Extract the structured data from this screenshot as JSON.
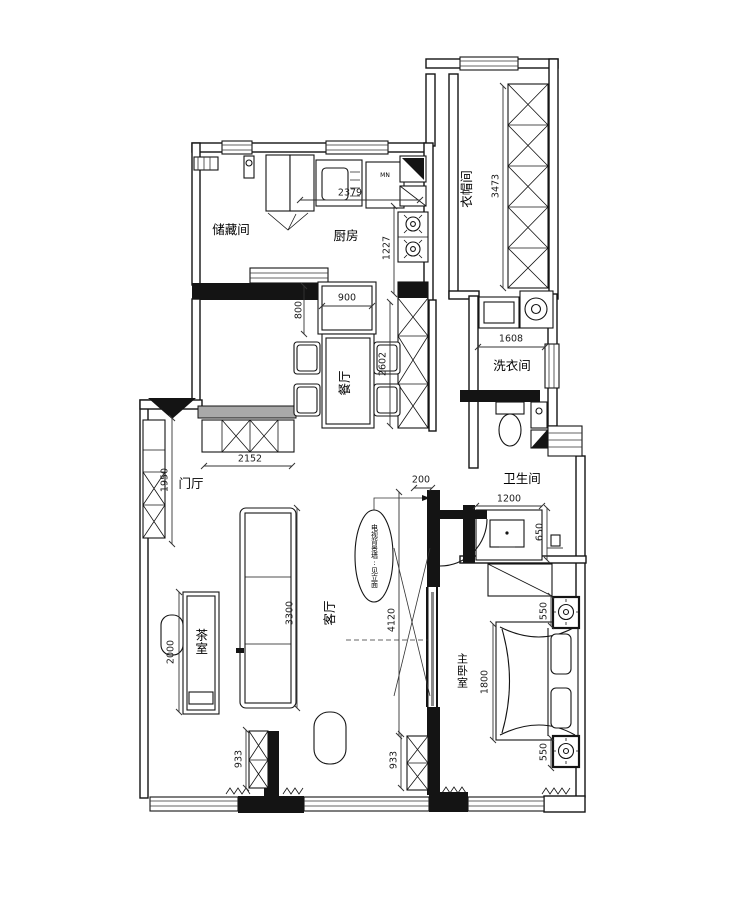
{
  "rooms": {
    "storage": "储藏间",
    "kitchen": "厨房",
    "cloakroom": "衣帽间",
    "laundry": "洗衣间",
    "dining": "餐厅",
    "bathroom": "卫生间",
    "hall": "门厅",
    "living": "客厅",
    "tea": "茶室",
    "master": "主卧室"
  },
  "dims": {
    "kitchen_width": "2379",
    "kitchen_depth": "1227",
    "cabinet_900": "900",
    "cabinet_800": "800",
    "tall_cabinet": "2602",
    "cloak_depth": "3473",
    "laundry_width": "1608",
    "hall_cabinet": "2152",
    "hall_depth": "1950",
    "wall_200": "200",
    "living_depth": "4120",
    "sofa_length": "3300",
    "tea_table": "2000",
    "cabinet_left": "933",
    "cabinet_right": "933",
    "vanity_width": "1200",
    "vanity_depth": "650",
    "bed_width": "1800",
    "nightstand_top": "550",
    "nightstand_bottom": "550"
  },
  "callout": "电视背景墙:见立面",
  "labels": {
    "appliance": "MN"
  }
}
